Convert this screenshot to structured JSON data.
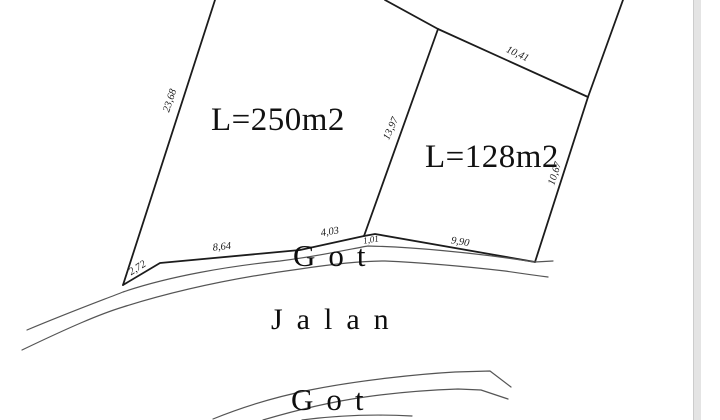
{
  "parcels": [
    {
      "area_label": "L=250m2"
    },
    {
      "area_label": "L=128m2"
    }
  ],
  "dimensions": {
    "left_edge": "23,68",
    "divider_edge": "13,97",
    "top_right_edge": "10,41",
    "right_edge": "10,67",
    "bottom_edge_1": "2,72",
    "bottom_edge_2": "8,64",
    "bottom_edge_3": "4,03",
    "bottom_edge_4": "1,01",
    "bottom_edge_5": "9,90"
  },
  "labels": {
    "ditch_top": "Got",
    "road": "Jalan",
    "ditch_bottom": "Got"
  },
  "colors": {
    "boundary_line": "#1c1c1c",
    "ditch_line": "#555555",
    "background": "#ffffff",
    "scroll_strip": "#e4e4e4"
  }
}
